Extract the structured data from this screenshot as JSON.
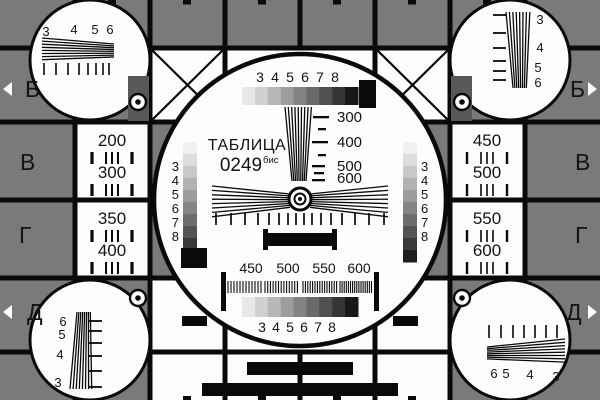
{
  "palette": {
    "background": "#7a7a7a",
    "dark_square": "#585858",
    "ink": "#0a0a0a",
    "white": "#fdfdfd",
    "text": "#141414"
  },
  "title": {
    "word": "ТАБЛИЦА",
    "number": "0249",
    "suffix": "бис"
  },
  "markers": {
    "b": "Б",
    "v": "В",
    "g": "Г",
    "d": "Д"
  },
  "corner_labels": {
    "top_left": [
      "3",
      "4",
      "5",
      "6"
    ],
    "top_right": [
      "3",
      "4",
      "5",
      "6"
    ],
    "bottom_left": [
      "6",
      "5",
      "4",
      "3"
    ],
    "bottom_right": [
      "6",
      "5",
      "4",
      "3"
    ]
  },
  "center": {
    "gray_scale_numbers": [
      "3",
      "4",
      "5",
      "6",
      "7",
      "8"
    ],
    "wedge_frequencies": [
      "300",
      "400",
      "500",
      "600"
    ],
    "burst_frequencies": [
      "450",
      "500",
      "550",
      "600"
    ]
  },
  "resolution_labels": {
    "left_top": [
      "200",
      "300"
    ],
    "left_bottom": [
      "350",
      "400"
    ],
    "right_top": [
      "450",
      "500"
    ],
    "right_bottom": [
      "550",
      "600"
    ]
  },
  "grayscale": {
    "horizontal_steps": [
      "#e8e8e8",
      "#d0d0d0",
      "#b7b7b7",
      "#9d9d9d",
      "#838383",
      "#6a6a6a",
      "#505050",
      "#353535",
      "#181818"
    ],
    "vertical_steps": [
      "#f0f0f0",
      "#dddddd",
      "#c8c8c8",
      "#b2b2b2",
      "#9c9c9c",
      "#858585",
      "#6d6d6d",
      "#545454",
      "#3a3a3a",
      "#1e1e1e"
    ]
  }
}
